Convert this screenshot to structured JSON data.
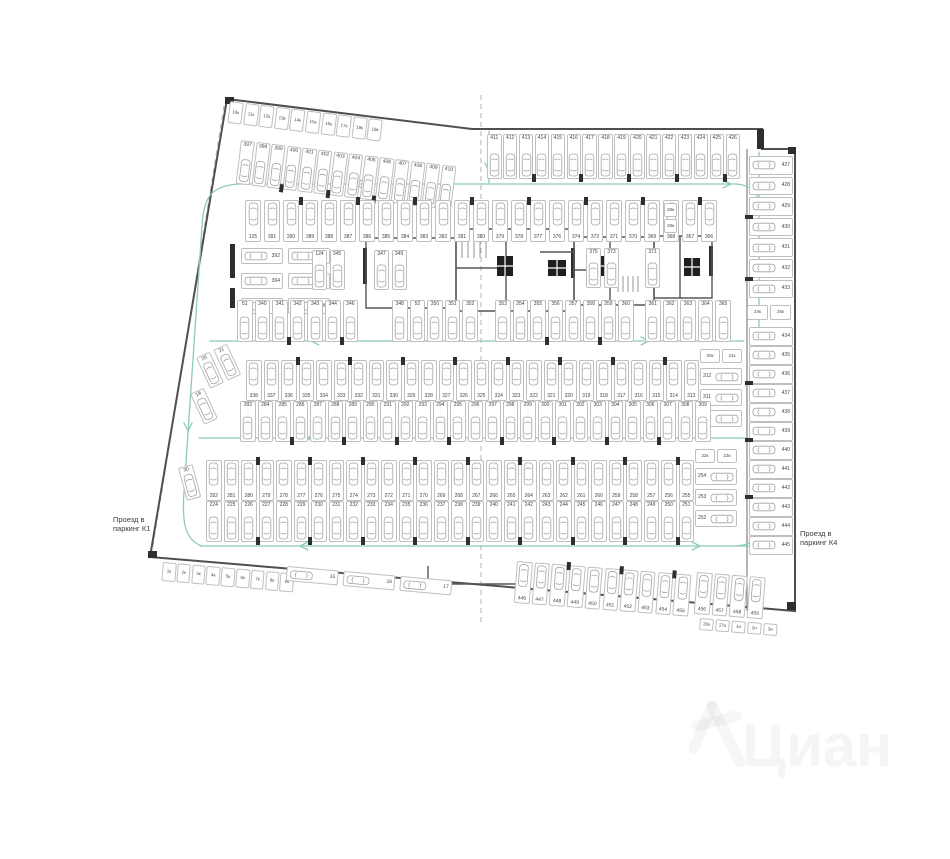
{
  "title": "План этажа паркинга",
  "labels": {
    "left_driveway": "Проезд в\nпаркинг К1",
    "right_driveway": "Проезд в\nпаркинг К4"
  },
  "watermark": {
    "text": "Циан"
  },
  "colors": {
    "wall": "#4f4f4f",
    "stall_border": "#bfbfbf",
    "number": "#454545",
    "car_outline": "#a3a3a3",
    "column": "#2e2e2e",
    "arrow": "#8ecdb0",
    "axis": "#b3b3b3"
  },
  "stall_rows": [
    {
      "name": "top-storage-row",
      "x": 230,
      "y": 101,
      "rot": 7,
      "stepX": 15.6,
      "w": 14,
      "h": 22,
      "small": true,
      "orient": "v",
      "car": false,
      "numbers": [
        "10к",
        "11к",
        "12к",
        "13к",
        "14к",
        "15к",
        "16к",
        "17к",
        "18к",
        "19к"
      ]
    },
    {
      "name": "top-parking-left",
      "x": 241,
      "y": 140,
      "rot": 7,
      "stepX": 15.6,
      "w": 14.2,
      "h": 44,
      "orient": "v",
      "num_pos": "top",
      "car": true,
      "cols": "bottom",
      "numbers": [
        "397",
        "398",
        "399",
        "400",
        "401",
        "402",
        "403",
        "404",
        "405",
        "406",
        "407",
        "408",
        "409",
        "410"
      ]
    },
    {
      "name": "top-parking-right",
      "x": 487,
      "y": 134,
      "stepX": 15.9,
      "w": 14.5,
      "h": 45,
      "orient": "v",
      "num_pos": "top",
      "car": true,
      "cols": "bottom",
      "numbers": [
        "411",
        "412",
        "413",
        "414",
        "415",
        "416",
        "417",
        "418",
        "419",
        "420",
        "421",
        "422",
        "423",
        "424",
        "425",
        "426"
      ]
    },
    {
      "name": "right-column-upper",
      "x": 749,
      "y": 156,
      "stepX": 0,
      "stepY": 20.6,
      "w": 44,
      "h": 18.5,
      "orient": "h",
      "num_pos": "right",
      "car": true,
      "cols": "left",
      "numbers": [
        "427",
        "428",
        "429",
        "430",
        "431",
        "432",
        "433"
      ]
    },
    {
      "name": "right-wall-storage-pair",
      "x": 747,
      "y": 305,
      "stepX": 23,
      "w": 21,
      "h": 15,
      "small": true,
      "orient": "h",
      "car": false,
      "numbers": [
        "24к",
        "25к"
      ]
    },
    {
      "name": "right-column-lower",
      "x": 749,
      "y": 327,
      "stepX": 0,
      "stepY": 19,
      "w": 44,
      "h": 18.5,
      "orient": "h",
      "num_pos": "right",
      "car": true,
      "cols": "left",
      "numbers": [
        "434",
        "435",
        "436",
        "437",
        "438",
        "439",
        "440",
        "441",
        "442",
        "443",
        "444",
        "445"
      ]
    },
    {
      "name": "band1-top-row",
      "x": 245,
      "y": 200,
      "stepX": 19,
      "w": 16,
      "h": 42,
      "orient": "v",
      "num_pos": "bottom",
      "car": true,
      "cols": "top",
      "numbers": [
        "125",
        "391",
        "390",
        "389",
        "388",
        "387",
        "386",
        "385",
        "384",
        "383",
        "382",
        "381",
        "380",
        "379",
        "378",
        "377",
        "376",
        "374",
        "372",
        "371",
        "370",
        "369",
        "368",
        "367",
        "366"
      ]
    },
    {
      "name": "band1-top-storage-stack",
      "x": 664,
      "y": 203,
      "stepX": 0,
      "stepY": 16,
      "w": 13,
      "h": 14,
      "small": true,
      "orient": "h",
      "car": false,
      "numbers": [
        "28к",
        "29к"
      ]
    },
    {
      "name": "band1-left-grid-col-a",
      "x": 241,
      "y": 248,
      "stepX": 0,
      "stepY": 25,
      "w": 42,
      "h": 16,
      "orient": "h",
      "num_pos": "right",
      "car": true,
      "numbers": [
        "392",
        "394",
        "395"
      ]
    },
    {
      "name": "band1-left-grid-col-b",
      "x": 288,
      "y": 248,
      "stepX": 0,
      "stepY": 25,
      "w": 42,
      "h": 16,
      "orient": "h",
      "num_pos": "right",
      "car": true,
      "numbers": [
        "393",
        "123",
        "396"
      ]
    },
    {
      "name": "band1-mid-pair-1",
      "x": 312,
      "y": 250,
      "stepX": 17.5,
      "w": 15,
      "h": 40,
      "orient": "v",
      "num_pos": "top",
      "car": true,
      "numbers": [
        "124",
        "345"
      ]
    },
    {
      "name": "band1-mid-pair-2",
      "x": 374,
      "y": 250,
      "stepX": 17.5,
      "w": 15,
      "h": 40,
      "orient": "v",
      "num_pos": "top",
      "car": true,
      "numbers": [
        "347",
        "349"
      ]
    },
    {
      "name": "band1-mid-pair-3",
      "x": 586,
      "y": 248,
      "stepX": 18,
      "w": 15,
      "h": 40,
      "orient": "v",
      "num_pos": "top",
      "car": true,
      "numbers": [
        "375",
        "373"
      ]
    },
    {
      "name": "band1-mid-single",
      "x": 645,
      "y": 248,
      "stepX": 18,
      "w": 15,
      "h": 40,
      "orient": "v",
      "num_pos": "top",
      "car": true,
      "numbers": [
        "371"
      ]
    },
    {
      "name": "band1-bottom-left",
      "x": 237,
      "y": 300,
      "stepX": 17.6,
      "w": 15.5,
      "h": 42,
      "orient": "v",
      "num_pos": "top",
      "car": true,
      "cols": "bottom",
      "numbers": [
        "51",
        "340",
        "341",
        "342",
        "343",
        "344",
        "346"
      ]
    },
    {
      "name": "band1-bottom-mid",
      "x": 392,
      "y": 300,
      "stepX": 17.6,
      "w": 15.5,
      "h": 42,
      "orient": "v",
      "num_pos": "top",
      "car": true,
      "numbers": [
        "348",
        "52",
        "350",
        "351",
        "352"
      ]
    },
    {
      "name": "band1-bottom-right",
      "x": 495,
      "y": 300,
      "stepX": 17.6,
      "w": 15.5,
      "h": 42,
      "orient": "v",
      "num_pos": "top",
      "car": true,
      "cols": "bottom",
      "numbers": [
        "353",
        "354",
        "355",
        "356",
        "357",
        "358",
        "359",
        "360"
      ]
    },
    {
      "name": "band1-bottom-right-2",
      "x": 645,
      "y": 300,
      "stepX": 17.6,
      "w": 15.5,
      "h": 42,
      "orient": "v",
      "num_pos": "top",
      "car": true,
      "numbers": [
        "361",
        "362",
        "363",
        "364",
        "365"
      ]
    },
    {
      "name": "band2-top-row",
      "x": 246,
      "y": 360,
      "stepX": 17.5,
      "w": 15.5,
      "h": 41,
      "orient": "v",
      "num_pos": "bottom",
      "car": true,
      "cols": "top",
      "numbers": [
        "338",
        "337",
        "336",
        "335",
        "334",
        "333",
        "332",
        "331",
        "330",
        "329",
        "328",
        "327",
        "326",
        "325",
        "324",
        "323",
        "322",
        "321",
        "320",
        "319",
        "318",
        "317",
        "316",
        "315",
        "314",
        "313"
      ]
    },
    {
      "name": "band2-right-storage-pair",
      "x": 700,
      "y": 349,
      "stepX": 22,
      "w": 20,
      "h": 14,
      "small": true,
      "orient": "h",
      "car": false,
      "numbers": [
        "20к",
        "21к"
      ]
    },
    {
      "name": "band2-right-block",
      "x": 700,
      "y": 368,
      "stepX": 0,
      "stepY": 21,
      "w": 42,
      "h": 17,
      "orient": "h",
      "num_pos": "left",
      "car": true,
      "numbers": [
        "312",
        "311",
        "310"
      ]
    },
    {
      "name": "band2-bottom-row",
      "x": 240,
      "y": 401,
      "stepX": 17.5,
      "w": 15.5,
      "h": 41,
      "orient": "v",
      "num_pos": "top",
      "car": true,
      "cols": "bottom",
      "numbers": [
        "283",
        "284",
        "285",
        "286",
        "287",
        "288",
        "289",
        "290",
        "291",
        "292",
        "293",
        "294",
        "295",
        "296",
        "297",
        "298",
        "299",
        "300",
        "301",
        "302",
        "303",
        "304",
        "305",
        "306",
        "307",
        "308",
        "309"
      ]
    },
    {
      "name": "left-diagonal-pair",
      "x": 196,
      "y": 358,
      "rot": -25,
      "stepX": 19,
      "w": 15,
      "h": 34,
      "orient": "v",
      "num_pos": "top",
      "car": true,
      "numbers": [
        "20",
        "21"
      ]
    },
    {
      "name": "left-diagonal-single",
      "x": 190,
      "y": 394,
      "rot": -25,
      "stepX": 19,
      "w": 15,
      "h": 34,
      "orient": "v",
      "num_pos": "top",
      "car": true,
      "numbers": [
        "19"
      ]
    },
    {
      "name": "band3-top-row",
      "x": 206,
      "y": 460,
      "stepX": 17.5,
      "w": 15.5,
      "h": 41,
      "orient": "v",
      "num_pos": "bottom",
      "car": true,
      "cols": "top",
      "numbers": [
        "282",
        "281",
        "280",
        "279",
        "278",
        "277",
        "276",
        "275",
        "274",
        "273",
        "272",
        "271",
        "270",
        "269",
        "268",
        "267",
        "266",
        "265",
        "264",
        "263",
        "262",
        "261",
        "260",
        "259",
        "258",
        "257",
        "256",
        "255"
      ]
    },
    {
      "name": "band3-right-storage-pair",
      "x": 695,
      "y": 449,
      "stepX": 22,
      "w": 20,
      "h": 14,
      "small": true,
      "orient": "h",
      "car": false,
      "numbers": [
        "22к",
        "23к"
      ]
    },
    {
      "name": "band3-right-block",
      "x": 695,
      "y": 468,
      "stepX": 0,
      "stepY": 21,
      "w": 42,
      "h": 17,
      "orient": "h",
      "num_pos": "left",
      "car": true,
      "numbers": [
        "254",
        "253",
        "252"
      ]
    },
    {
      "name": "band3-bottom-row",
      "x": 206,
      "y": 501,
      "stepX": 17.5,
      "w": 15.5,
      "h": 41,
      "orient": "v",
      "num_pos": "top",
      "car": true,
      "cols": "bottom",
      "numbers": [
        "224",
        "225",
        "226",
        "227",
        "228",
        "229",
        "230",
        "231",
        "232",
        "233",
        "234",
        "235",
        "236",
        "237",
        "238",
        "239",
        "240",
        "241",
        "242",
        "243",
        "244",
        "245",
        "246",
        "247",
        "248",
        "249",
        "250",
        "251"
      ]
    },
    {
      "name": "left-single-stall",
      "x": 178,
      "y": 468,
      "rot": -15,
      "stepX": 19,
      "w": 15,
      "h": 34,
      "orient": "v",
      "num_pos": "top",
      "car": true,
      "numbers": [
        "30"
      ]
    },
    {
      "name": "bottom-storage-row",
      "x": 163,
      "y": 562,
      "rot": 5,
      "stepX": 14.8,
      "w": 13.5,
      "h": 19,
      "small": true,
      "orient": "v",
      "car": false,
      "numbers": [
        "1к",
        "2к",
        "3к",
        "4к",
        "5к",
        "6к",
        "7к",
        "8к",
        "9к"
      ]
    },
    {
      "name": "bottom-horizontal-stalls",
      "x": 287,
      "y": 566,
      "rot": 5,
      "stepX": 57,
      "w": 52,
      "h": 15,
      "orient": "h",
      "num_pos": "right",
      "car": true,
      "numbers": [
        "15",
        "16",
        "17"
      ]
    },
    {
      "name": "bottom-parking-main",
      "x": 517,
      "y": 561,
      "rot": 4.5,
      "stepX": 17.7,
      "w": 15.5,
      "h": 42,
      "orient": "v",
      "num_pos": "bottom",
      "car": true,
      "cols": "top",
      "numbers": [
        "446",
        "447",
        "448",
        "449",
        "450",
        "451",
        "452",
        "453",
        "454",
        "455"
      ]
    },
    {
      "name": "bottom-parking-right",
      "x": 697,
      "y": 572,
      "rot": 4.5,
      "stepX": 17.7,
      "w": 15.5,
      "h": 42,
      "orient": "v",
      "num_pos": "bottom",
      "car": true,
      "numbers": [
        "456",
        "457",
        "458",
        "459"
      ]
    },
    {
      "name": "bottom-right-storage",
      "x": 700,
      "y": 618,
      "rot": 4.5,
      "stepX": 16,
      "w": 14,
      "h": 12,
      "small": true,
      "orient": "h",
      "car": false,
      "numbers": [
        "26к",
        "27к",
        "1н",
        "2н",
        "3н"
      ]
    }
  ]
}
